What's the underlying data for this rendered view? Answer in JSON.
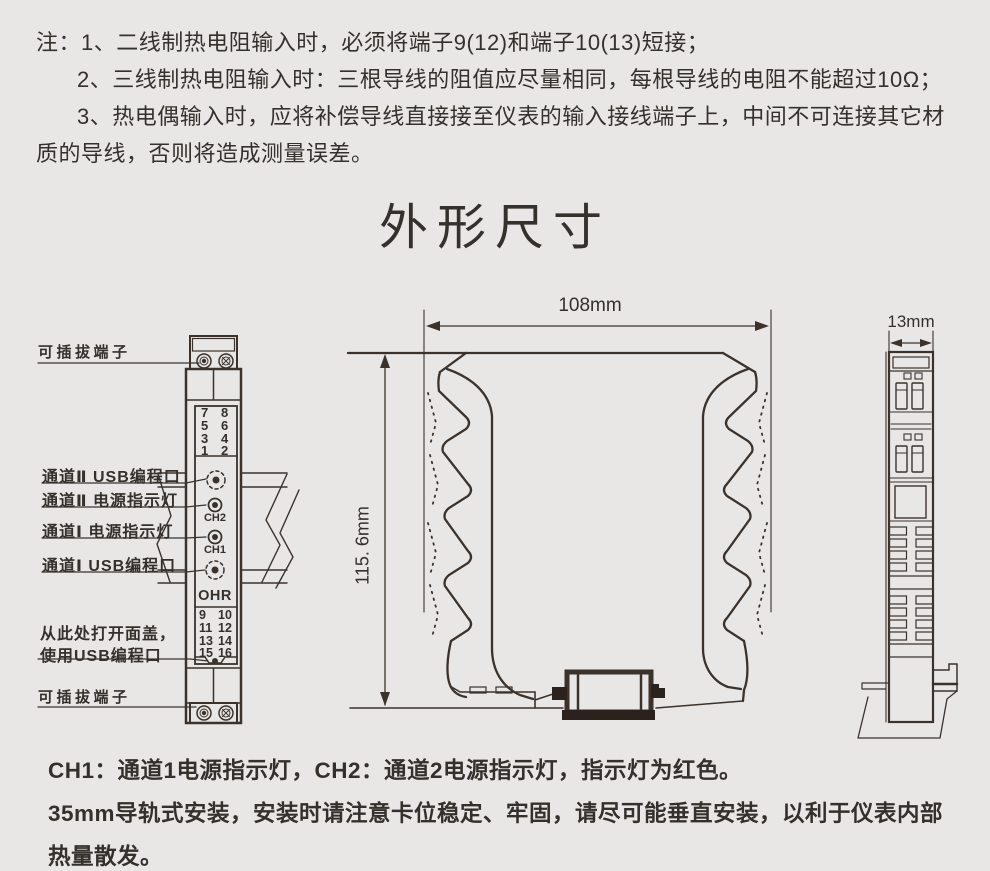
{
  "page": {
    "background": "#e9e7e6",
    "ink": "#34302b",
    "line_color": "#3b322c"
  },
  "top_notes": {
    "lines": [
      "注：1、二线制热电阻输入时，必须将端子9(12)和端子10(13)短接；",
      "2、三线制热电阻输入时：三根导线的阻值应尽量相同，每根导线的电阻不能超过10Ω；",
      "3、热电偶输入时，应将补偿导线直接接至仪表的输入接线端子上，中间不可连接其它材",
      "质的导线，否则将造成测量误差。"
    ]
  },
  "title": "外形尺寸",
  "front_view": {
    "callouts": {
      "top_terminal": "可插拔端子",
      "ch2_usb": "通道Ⅱ USB编程口",
      "ch2_led": "通道Ⅱ 电源指示灯",
      "ch1_led": "通道Ⅰ 电源指示灯",
      "ch1_usb": "通道Ⅰ USB编程口",
      "open_cover_1": "从此处打开面盖，",
      "open_cover_2": "使用USB编程口",
      "bottom_terminal": "可插拔端子"
    },
    "terminals_top_left": "7\n5\n3\n1",
    "terminals_top_right": "8\n6\n4\n2",
    "terminals_bottom_left": "9\n11\n13\n15",
    "terminals_bottom_right": "10\n12\n14\n16",
    "led_ch2": "CH2",
    "led_ch1": "CH1",
    "brand": "OHR"
  },
  "dimensions": {
    "width": "108mm",
    "height": "115. 6mm",
    "depth": "13mm"
  },
  "footer_notes": {
    "lines": [
      "CH1：通道1电源指示灯，CH2：通道2电源指示灯，指示灯为红色。",
      "35mm导轨式安装，安装时请注意卡位稳定、牢固，请尽可能垂直安装，以利于仪表内部",
      "热量散发。"
    ]
  }
}
